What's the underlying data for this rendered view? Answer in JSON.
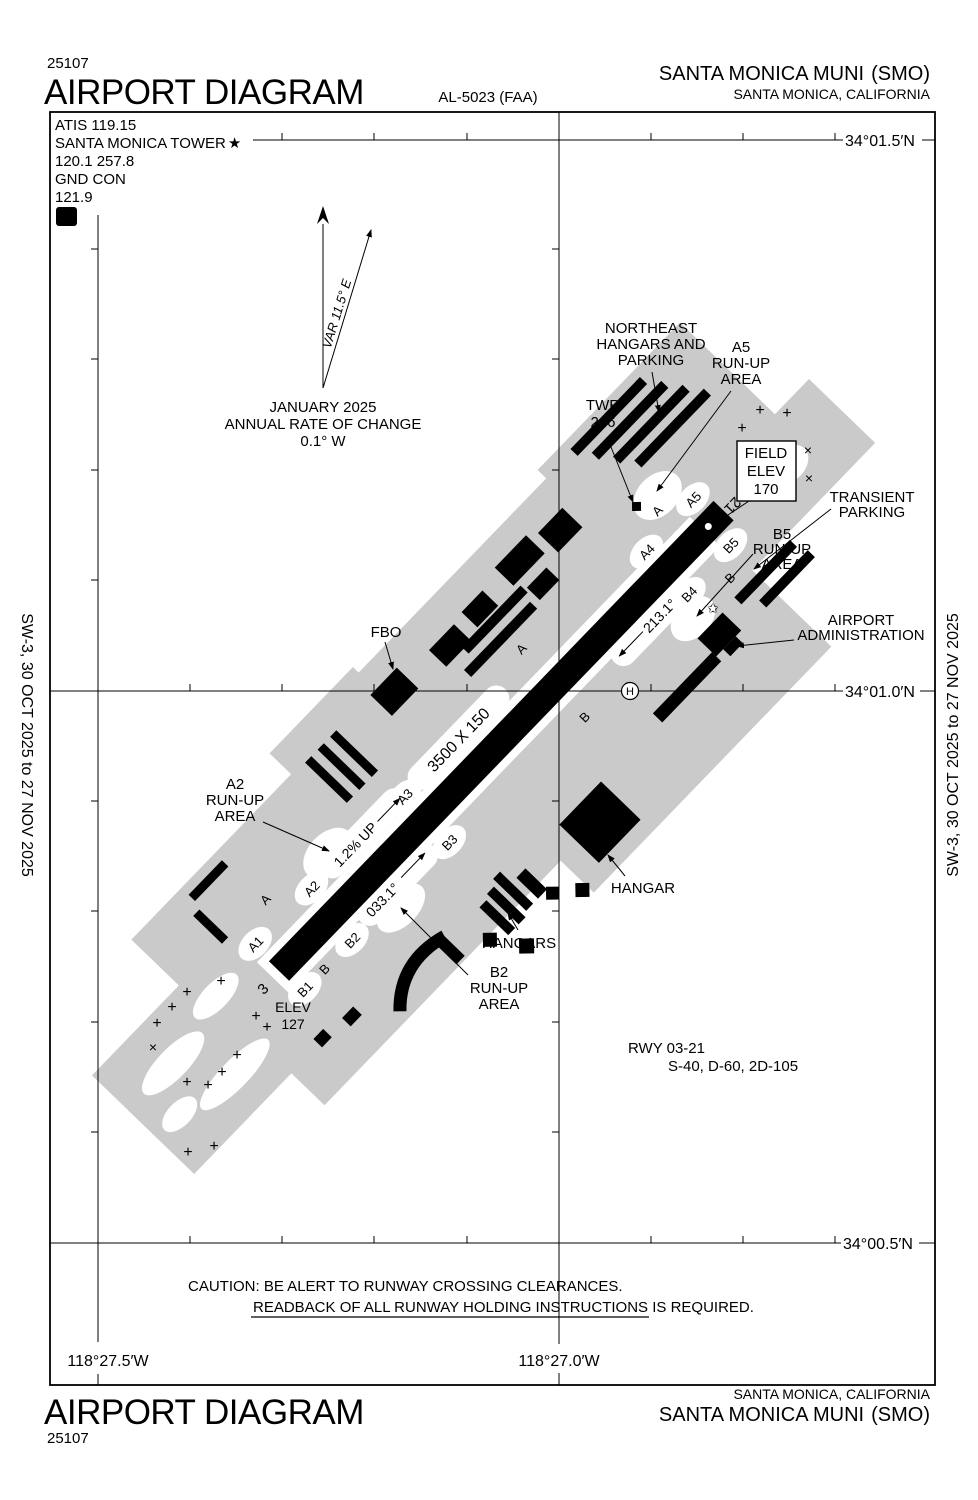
{
  "header": {
    "chart_number": "25107",
    "title": "AIRPORT DIAGRAM",
    "al_number": "AL-5023 (FAA)",
    "airport_name": "SANTA MONICA MUNI",
    "airport_id": "(SMO)",
    "city_state": "SANTA MONICA, CALIFORNIA"
  },
  "comm_box": {
    "atis": "ATIS  119.15",
    "tower_label": "SANTA MONICA TOWER",
    "tower_star": "★",
    "tower_freqs": "120.1  257.8",
    "gnd_label": "GND CON",
    "gnd_freq": "121.9",
    "hold_d": "D"
  },
  "compass": {
    "variation": "VAR 11.5° E",
    "annual_line1": "JANUARY 2025",
    "annual_line2": "ANNUAL RATE OF CHANGE",
    "annual_line3": "0.1° W"
  },
  "grid": {
    "lat_top": "34°01.5′N",
    "lat_mid": "34°01.0′N",
    "lat_bottom": "34°00.5′N",
    "lon_left": "118°27.5′W",
    "lon_center": "118°27.0′W"
  },
  "field": {
    "ne_hangars": [
      "NORTHEAST",
      "HANGARS AND",
      "PARKING"
    ],
    "a5_runup": [
      "A5",
      "RUN-UP",
      "AREA"
    ],
    "twr": [
      "TWR",
      "246"
    ],
    "field_elev": [
      "FIELD",
      "ELEV",
      "170"
    ],
    "transient": [
      "TRANSIENT",
      "PARKING"
    ],
    "b5_runup": [
      "B5",
      "RUN-UP",
      "AREA"
    ],
    "admin": [
      "AIRPORT",
      "ADMINISTRATION"
    ],
    "fbo": "FBO",
    "a2_runup": [
      "A2",
      "RUN-UP",
      "AREA"
    ],
    "hangar": "HANGAR",
    "hangars": "HANGARS",
    "b2_runup": [
      "B2",
      "RUN-UP",
      "AREA"
    ],
    "elev_sw": [
      "ELEV",
      "127"
    ],
    "helipad": "H",
    "beacon_star": "✩"
  },
  "runway": {
    "dims": "3500 X 150",
    "end_sw": "3",
    "end_ne": "21",
    "slope": "1.2% UP",
    "heading_ne": "213.1°",
    "heading_sw": "033.1°"
  },
  "taxiways": [
    "A",
    "A",
    "A",
    "A1",
    "A2",
    "A3",
    "A4",
    "A5",
    "B",
    "B",
    "B",
    "B1",
    "B2",
    "B3",
    "B4",
    "B5"
  ],
  "notes": {
    "rwy_line1": "RWY 03-21",
    "rwy_line2": "S-40, D-60, 2D-105",
    "caution_line1": "CAUTION: BE ALERT TO RUNWAY CROSSING CLEARANCES.",
    "caution_line2": "READBACK OF ALL RUNWAY HOLDING INSTRUCTIONS IS REQUIRED."
  },
  "margins": {
    "edition": "SW-3,  30 OCT 2025  to  27 NOV 2025"
  },
  "footer": {
    "city_state": "SANTA MONICA, CALIFORNIA",
    "airport_name": "SANTA MONICA MUNI",
    "airport_id": "(SMO)",
    "title": "AIRPORT DIAGRAM",
    "chart_number": "25107"
  },
  "symbols": {
    "plus": "+",
    "cross": "×"
  },
  "colors": {
    "apron_gray": "#cacaca",
    "ink": "#000000",
    "paper": "#ffffff"
  }
}
